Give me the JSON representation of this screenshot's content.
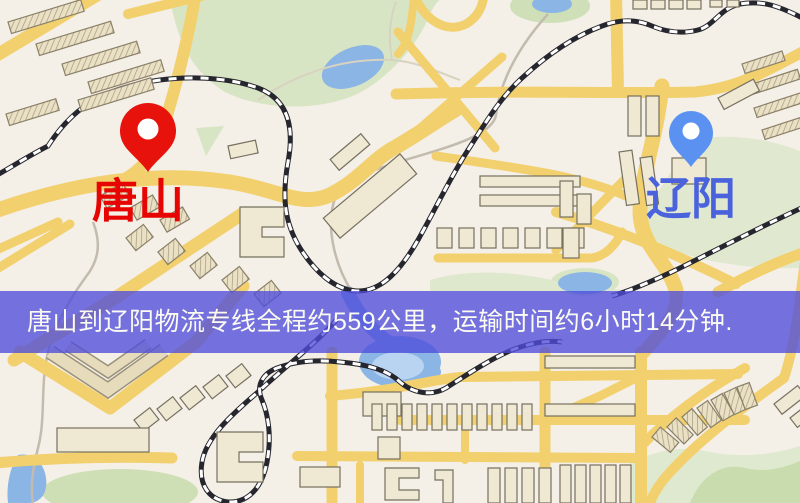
{
  "map": {
    "origin": {
      "label": "唐山",
      "pin_color": "#e8120c",
      "label_color": "#e60502"
    },
    "destination": {
      "label": "辽阳",
      "pin_color": "#5b92f2",
      "label_color": "#4a63dd"
    }
  },
  "banner": {
    "text": "唐山到辽阳物流专线全程约559公里，运输时间约6小时14分钟.",
    "background_rgba": "rgba(79,77,219,0.78)",
    "text_color": "#fbfbf2"
  },
  "palette": {
    "land": "#f4efe7",
    "park_green": "#d8e5c4",
    "pale_green": "#e0e9d0",
    "water_blue": "#8bb5e4",
    "road_yellow": "#f2d06e",
    "railway_dark": "#26262e",
    "building_tan": "#e9dfc2"
  }
}
